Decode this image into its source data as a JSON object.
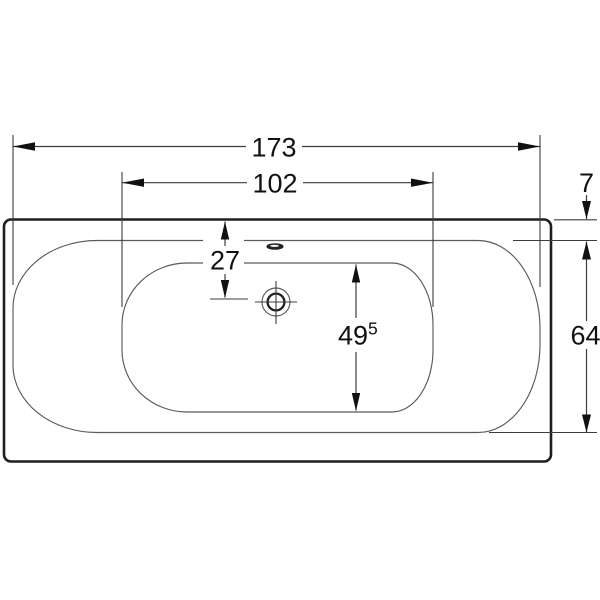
{
  "drawing": {
    "title": "bathtub-plan-view-technical-drawing",
    "units_note": "",
    "dimensions": {
      "overall_length": "173",
      "basin_length": "102",
      "rim_width_top": "7",
      "drain_center_from_edge": "27",
      "basin_width": "49",
      "basin_width_superscript": "5",
      "inner_width": "64"
    }
  }
}
